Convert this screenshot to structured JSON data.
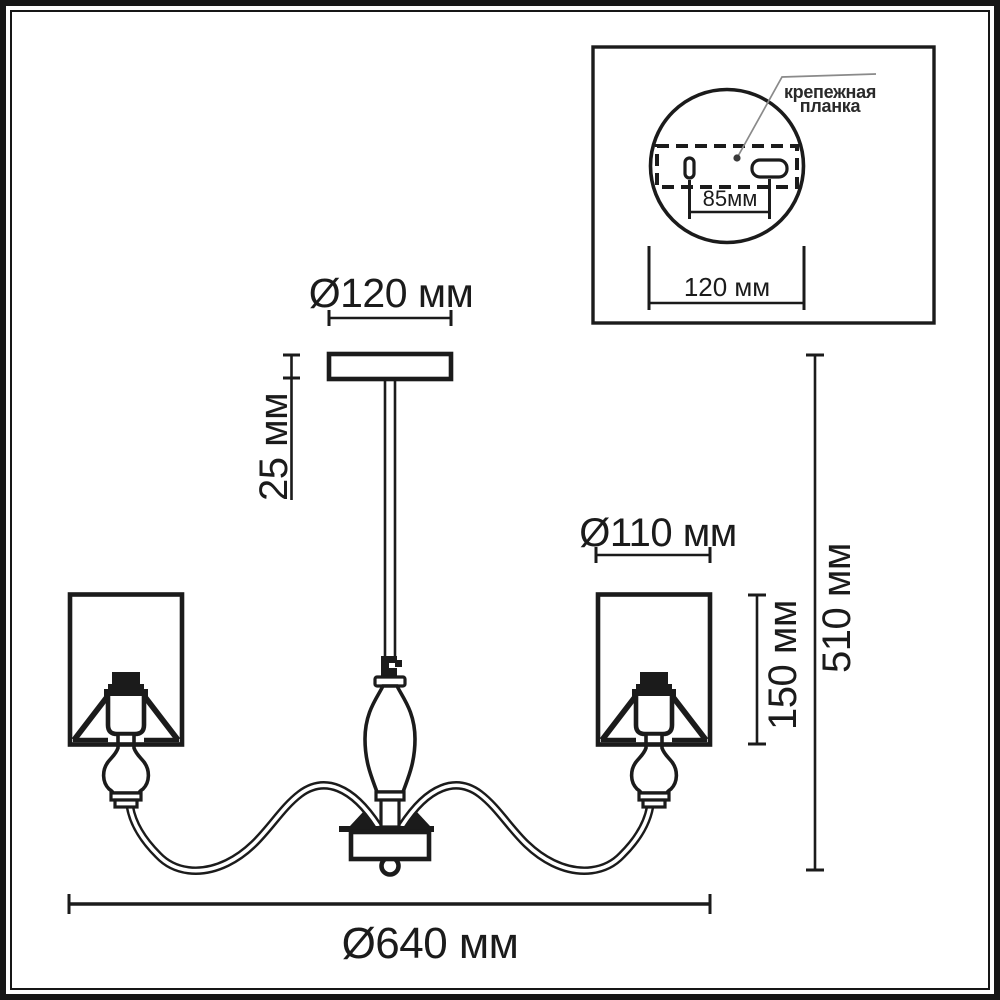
{
  "inset": {
    "label_line1": "крепежная",
    "label_line2": "планка",
    "holes_distance_label": "85мм",
    "plate_diameter_label": "120 мм"
  },
  "dimensions": {
    "canopy_diameter": "Ø120 мм",
    "canopy_height": "25 мм",
    "shade_diameter": "Ø110 мм",
    "shade_height": "150 мм",
    "total_height": "510 мм",
    "fixture_diameter": "Ø640 мм"
  },
  "colors": {
    "line": "#1b1b1b",
    "leader": "#8a8a8a",
    "background": "#ffffff"
  }
}
